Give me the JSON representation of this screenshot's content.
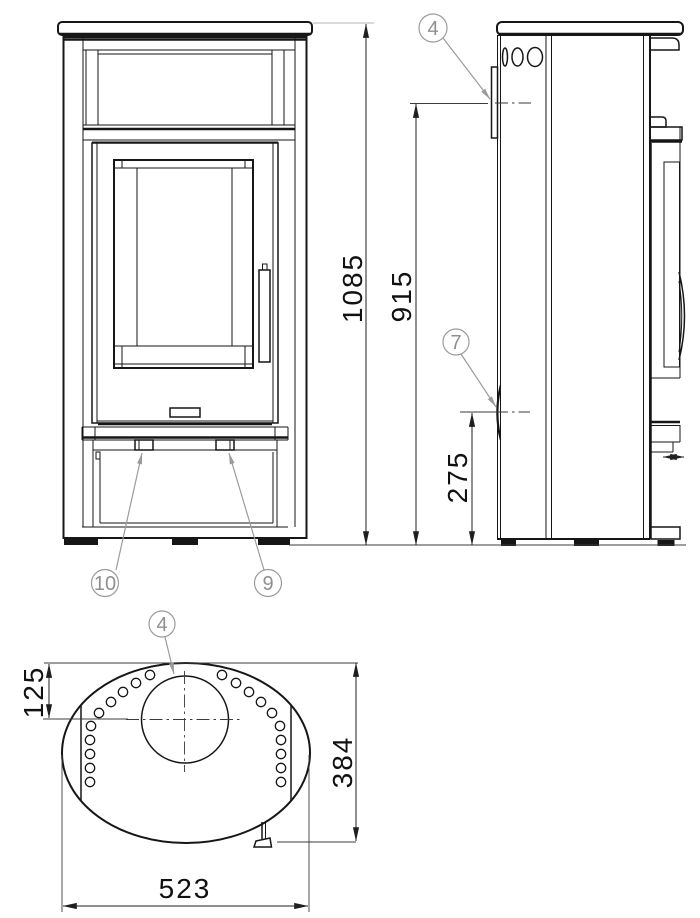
{
  "drawing": {
    "type": "stove-technical-drawing",
    "views": {
      "front": "front view",
      "side": "side view",
      "top": "top view"
    },
    "dims": {
      "overall_height": "1085",
      "flue_height": "915",
      "rear_port_height": "275",
      "flue_offset": "125",
      "depth": "384",
      "width": "523"
    },
    "callouts": {
      "side_flue": "4",
      "rear_port": "7",
      "front_left": "10",
      "front_right": "9",
      "top_flue": "4"
    },
    "colors": {
      "line": "#161616",
      "dimension": "#1f1f1f",
      "callout": "#9b9b9b",
      "extension_light": "#b3b3b3",
      "background": "#ffffff"
    }
  }
}
